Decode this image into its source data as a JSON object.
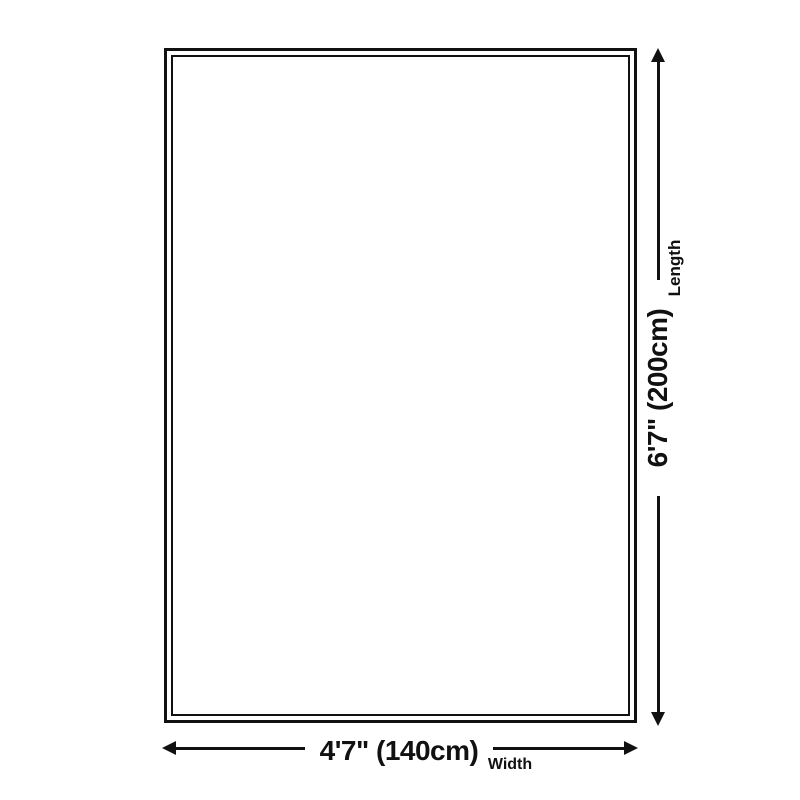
{
  "diagram": {
    "colors": {
      "ink": "#111111",
      "background": "#ffffff"
    },
    "length": {
      "value": "6'7\" (200cm)",
      "label": "Length"
    },
    "width": {
      "value": "4'7\" (140cm)",
      "label": "Width"
    }
  }
}
